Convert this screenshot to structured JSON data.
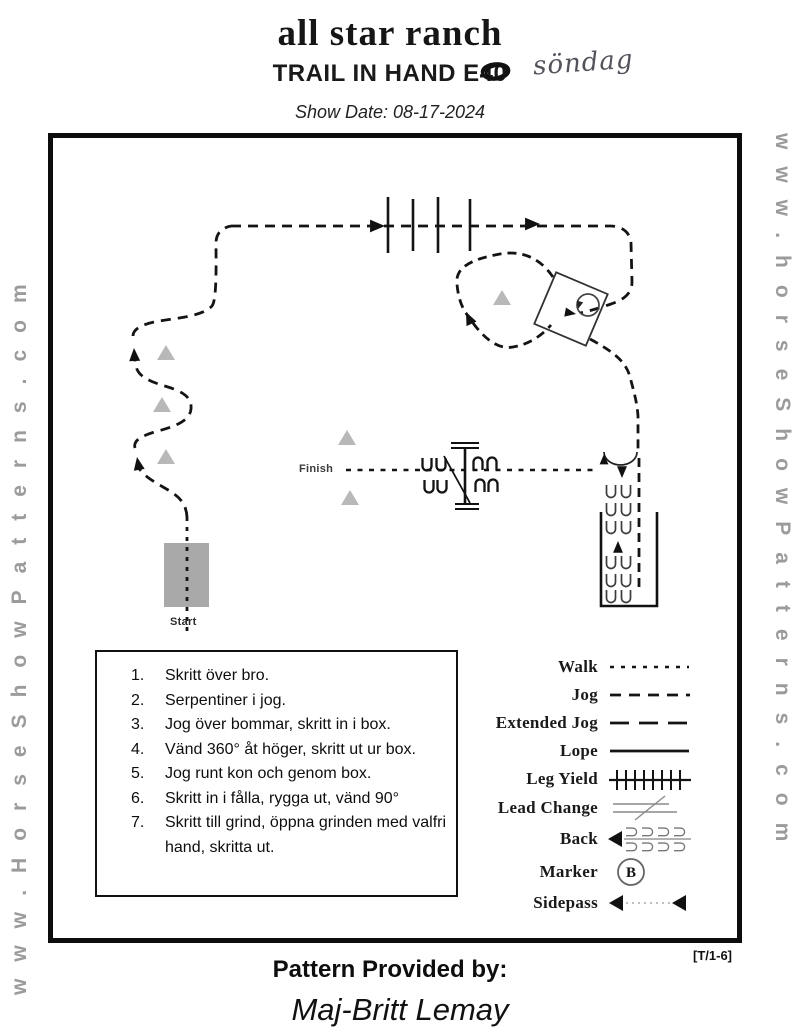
{
  "header": {
    "title": "all star ranch",
    "subtitle_prefix": "TRAIL IN HAND E",
    "subtitle_scribbled": "40",
    "handwritten_note": "söndag",
    "show_date": "Show Date: 08-17-2024"
  },
  "watermarks": {
    "left": "www.HorseShowPatterns.com",
    "right": "www.horseShowPatterns.com"
  },
  "diagram": {
    "start_label": "Start",
    "finish_label": "Finish"
  },
  "instructions": {
    "items": [
      "Skritt över bro.",
      "Serpentiner i jog.",
      "Jog över bommar, skritt in i box.",
      "Vänd 360° åt höger, skritt ut ur box.",
      "Jog runt kon och genom box.",
      "Skritt in i fålla, rygga ut, vänd 90°",
      "Skritt till grind, öppna grinden med valfri hand, skritta ut."
    ]
  },
  "legend": {
    "marker_letter": "B",
    "items": [
      {
        "label": "Walk"
      },
      {
        "label": "Jog"
      },
      {
        "label": "Extended Jog"
      },
      {
        "label": "Lope"
      },
      {
        "label": "Leg Yield"
      },
      {
        "label": "Lead Change"
      },
      {
        "label": "Back"
      },
      {
        "label": "Marker"
      },
      {
        "label": "Sidepass"
      }
    ]
  },
  "footer": {
    "provided_by": "Pattern Provided by:",
    "provider_name": "Maj-Britt Lemay",
    "pattern_code": "[T/1-6]"
  },
  "colors": {
    "ink": "#141414",
    "cone_gray": "#b8b8b8",
    "bridge_gray": "#a9a9a9",
    "watermark_gray": "#9b9b9b"
  }
}
